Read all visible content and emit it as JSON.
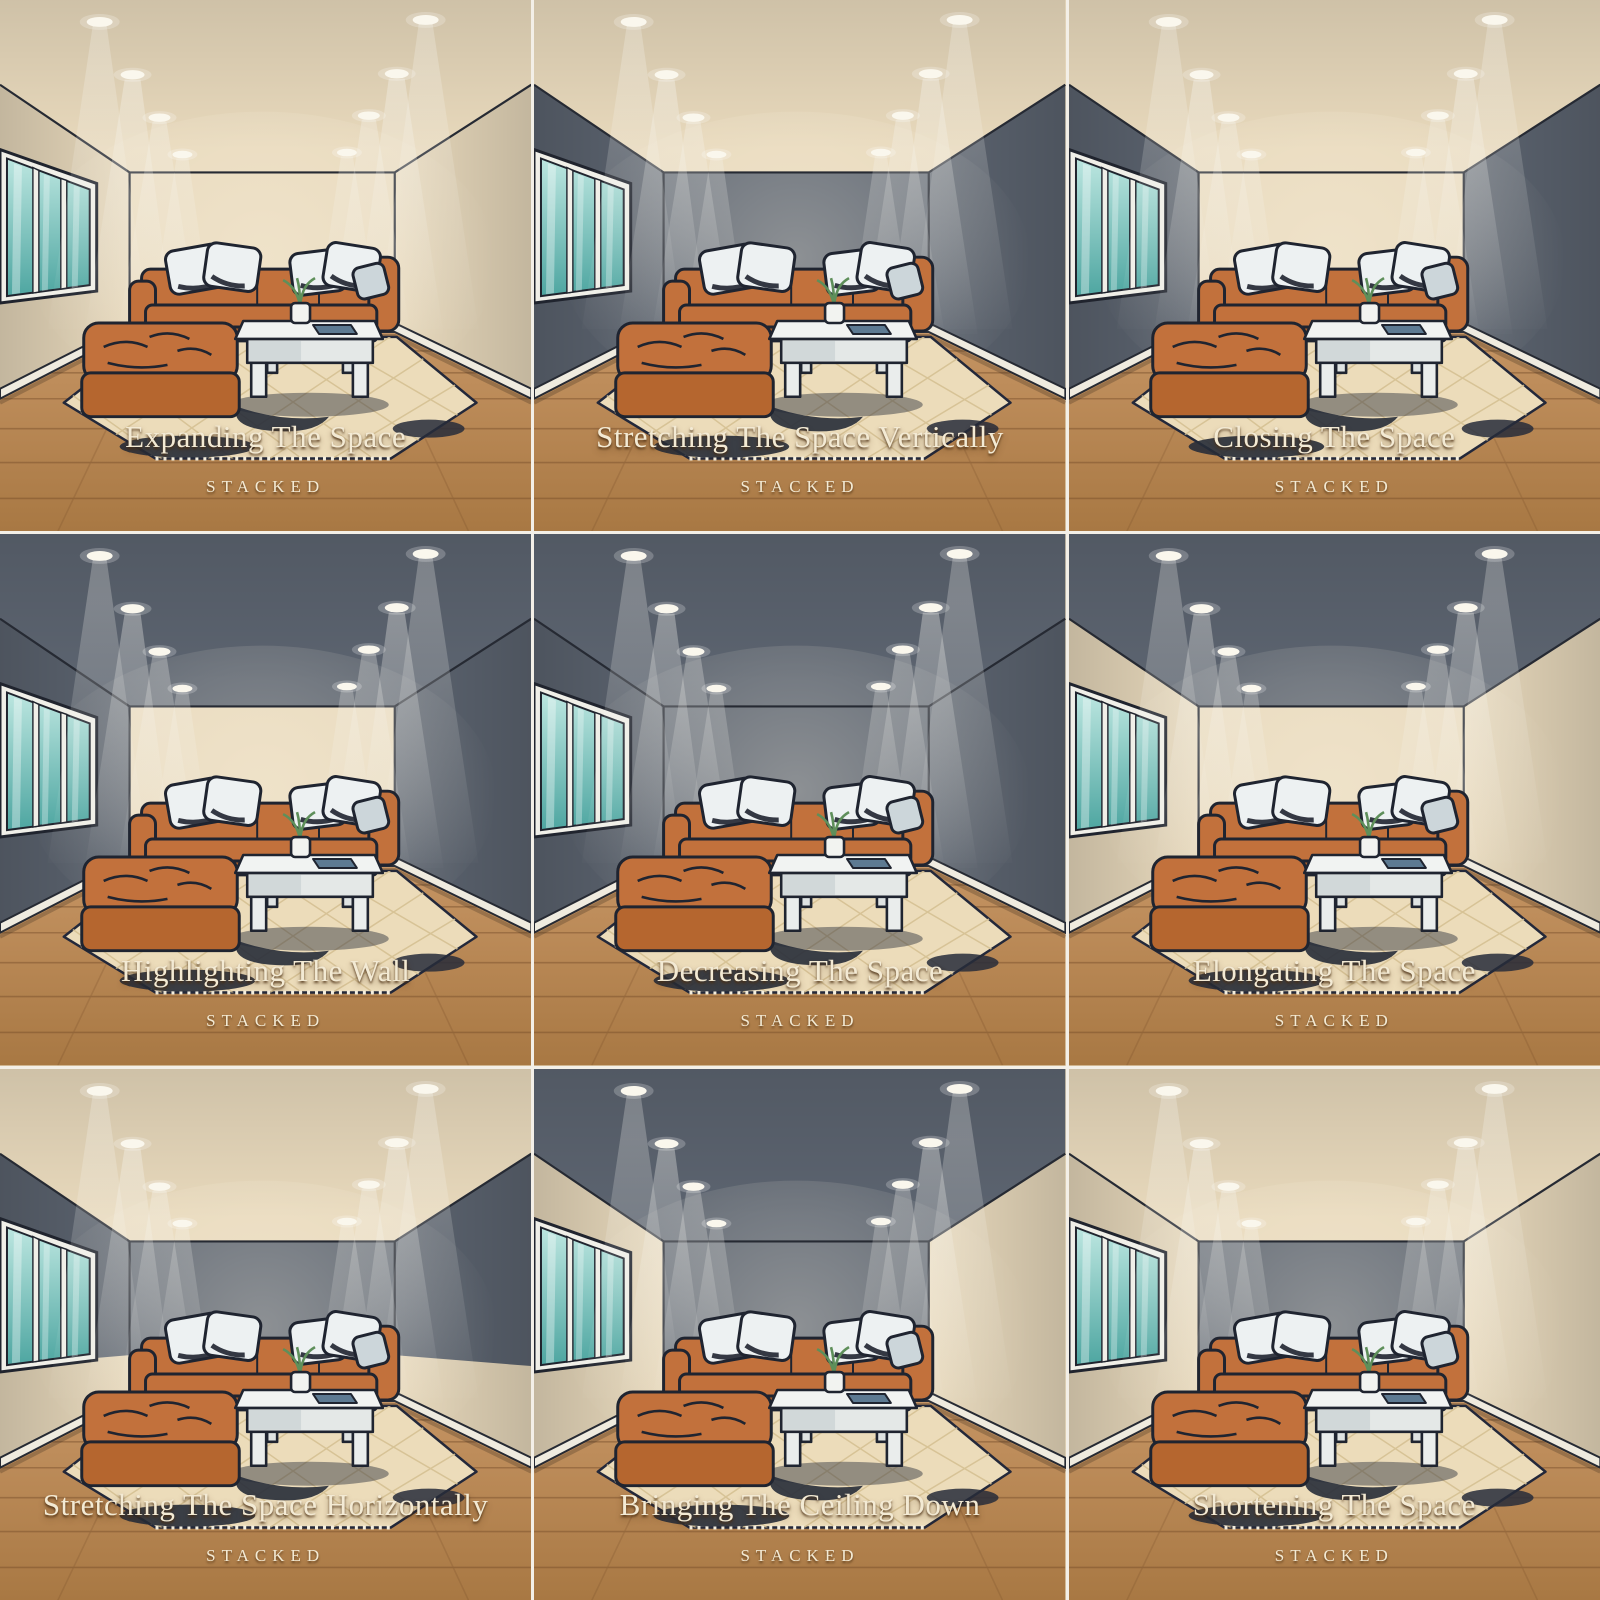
{
  "brand": "STACKED",
  "grid": {
    "rows": 3,
    "columns": 3
  },
  "palette": {
    "light_surface": "#e8d9bc",
    "dark_surface": "#5c6470",
    "floor_light": "#c59463",
    "floor_dark": "#a87843",
    "plank_line": "#6b4323",
    "baseboard": "#efebdf",
    "outline_ink": "#23283a",
    "sofa": "#c2713c",
    "sofa_shadow": "#a95f2c",
    "sofa_deep": "#b5662f",
    "pillow": "#edf1f2",
    "pillow_accent": "#ccd6da",
    "rug": "#ecdcba",
    "rug_pattern": "#d5c093",
    "rug_shadow": "#272c39",
    "table": "#f1f3f2",
    "book": "#5d7a92",
    "plant": "#5e8f5a",
    "window_frame": "#f0efe8",
    "glass_top": "#bce6e0",
    "glass_bottom": "#4ea6a1",
    "light_bulb": "#faf7ed",
    "caption_text": "#f3ead4",
    "divider": "#f3efe7"
  },
  "panels": [
    {
      "title": "Expanding The Space",
      "brand": "STACKED",
      "surfaces": {
        "ceiling": "light",
        "left_wall": "light",
        "back_wall": "light",
        "right_wall": "light"
      }
    },
    {
      "title": "Stretching The Space Vertically",
      "brand": "STACKED",
      "surfaces": {
        "ceiling": "light",
        "left_wall": "dark",
        "back_wall": "dark",
        "right_wall": "dark"
      }
    },
    {
      "title": "Closing The Space",
      "brand": "STACKED",
      "surfaces": {
        "ceiling": "light",
        "left_wall": "dark",
        "back_wall": "light",
        "right_wall": "dark"
      }
    },
    {
      "title": "Highlighting The Wall",
      "brand": "STACKED",
      "surfaces": {
        "ceiling": "dark",
        "left_wall": "dark",
        "back_wall": "light",
        "right_wall": "dark"
      }
    },
    {
      "title": "Decreasing The Space",
      "brand": "STACKED",
      "surfaces": {
        "ceiling": "dark",
        "left_wall": "dark",
        "back_wall": "dark",
        "right_wall": "dark"
      }
    },
    {
      "title": "Elongating The Space",
      "brand": "STACKED",
      "surfaces": {
        "ceiling": "dark",
        "left_wall": "light",
        "back_wall": "light",
        "right_wall": "light"
      }
    },
    {
      "title": "Stretching The Space Horizontally",
      "brand": "STACKED",
      "surfaces": {
        "ceiling": "light",
        "left_wall": "split",
        "back_wall": "split",
        "right_wall": "split"
      }
    },
    {
      "title": "Bringing The Ceiling Down",
      "brand": "STACKED",
      "surfaces": {
        "ceiling": "dark",
        "left_wall": "light",
        "back_wall": "dark",
        "right_wall": "light"
      }
    },
    {
      "title": "Shortening The Space",
      "brand": "STACKED",
      "surfaces": {
        "ceiling": "light",
        "left_wall": "light",
        "back_wall": "dark",
        "right_wall": "light"
      }
    }
  ]
}
